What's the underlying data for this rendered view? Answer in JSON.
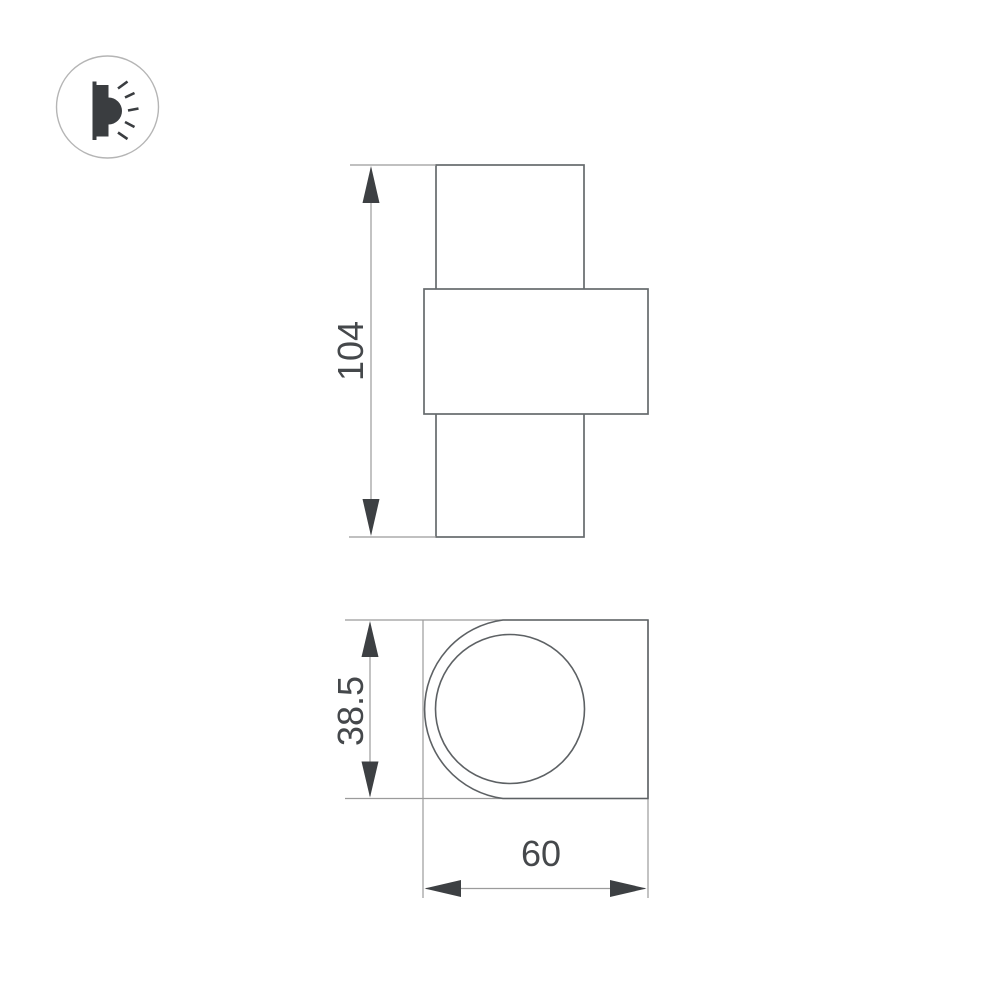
{
  "logo": {
    "icon": "wall-light-icon"
  },
  "views": {
    "front": {
      "height_label": "104"
    },
    "side": {
      "depth_label": "38.5",
      "width_label": "60"
    }
  },
  "dimensions": {
    "height": 104,
    "depth": 38.5,
    "width": 60
  },
  "colors": {
    "background": "#ffffff",
    "outline": "#666a6d",
    "dimension_line": "#9b9b9b",
    "arrow_and_text": "#3d4043",
    "logo_circle_stroke": "#b5b5b5"
  }
}
